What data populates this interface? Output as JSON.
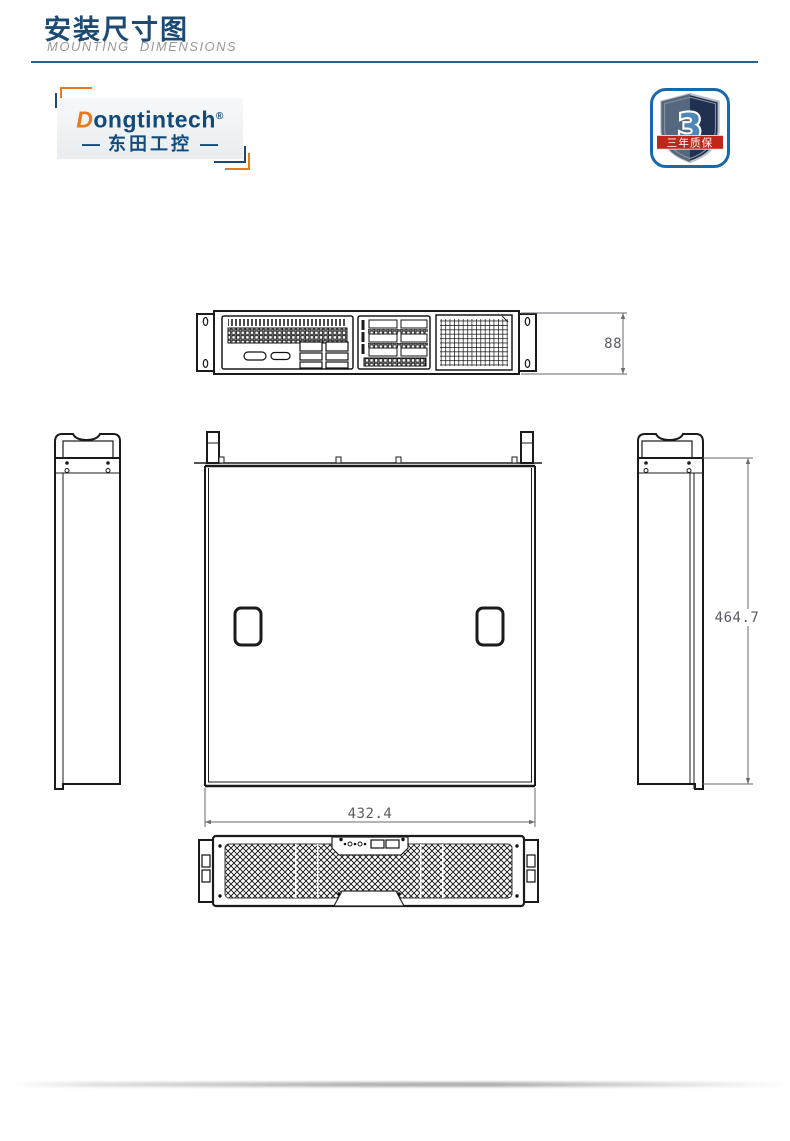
{
  "header": {
    "title": "安装尺寸图",
    "subtitle": "MOUNTING DIMENSIONS"
  },
  "logo": {
    "initial": "D",
    "rest": "ongtintech",
    "registered": "®",
    "dash_left": "—",
    "cn": "东田工控",
    "dash_right": "—"
  },
  "badge": {
    "number": "3",
    "label": "三年质保"
  },
  "dimensions": {
    "front_height": "88",
    "chassis_depth": "464.7",
    "chassis_width": "432.4"
  },
  "colors": {
    "title_navy": "#1d4a73",
    "divider_blue": "#27618f",
    "brand_navy": "#124a7b",
    "brand_orange": "#e87a1e",
    "badge_border_blue": "#1769a9",
    "ribbon_red": "#c0271c",
    "drawing_line": "#1b1b1b",
    "dimension_gray": "#5a5a62"
  }
}
